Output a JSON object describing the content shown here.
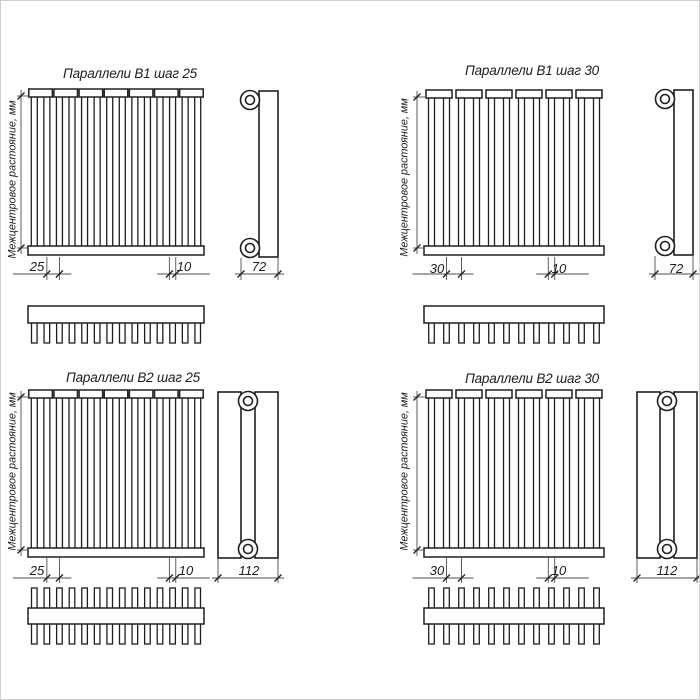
{
  "colors": {
    "background": "#ffffff",
    "line": "#1f1f1f",
    "dim_line": "#4d4d4d",
    "text": "#1c1c1c",
    "frame": "#cfcfcf"
  },
  "panels": [
    {
      "id": "b1-step-25",
      "title": "Параллели В1 шаг 25",
      "series": "В1",
      "axis_label": "Межцентровое растояние, мм",
      "dim_step": "25",
      "dim_tube_width": "10",
      "dim_depth": "72",
      "tube_count": 14
    },
    {
      "id": "b1-step-30",
      "title": "Параллели В1 шаг 30",
      "series": "В1",
      "axis_label": "Межцентровое растояние, мм",
      "dim_step": "30",
      "dim_tube_width": "10",
      "dim_depth": "72",
      "tube_count": 12
    },
    {
      "id": "b2-step-25",
      "title": "Параллели В2 шаг 25",
      "series": "В2",
      "axis_label": "Межцентровое растояние, мм",
      "dim_step": "25",
      "dim_tube_width": "10",
      "dim_depth": "112",
      "tube_count": 14
    },
    {
      "id": "b2-step-30",
      "title": "Параллели В2 шаг 30",
      "series": "В2",
      "axis_label": "Межцентровое растояние, мм",
      "dim_step": "30",
      "dim_tube_width": "10",
      "dim_depth": "112",
      "tube_count": 12
    }
  ]
}
